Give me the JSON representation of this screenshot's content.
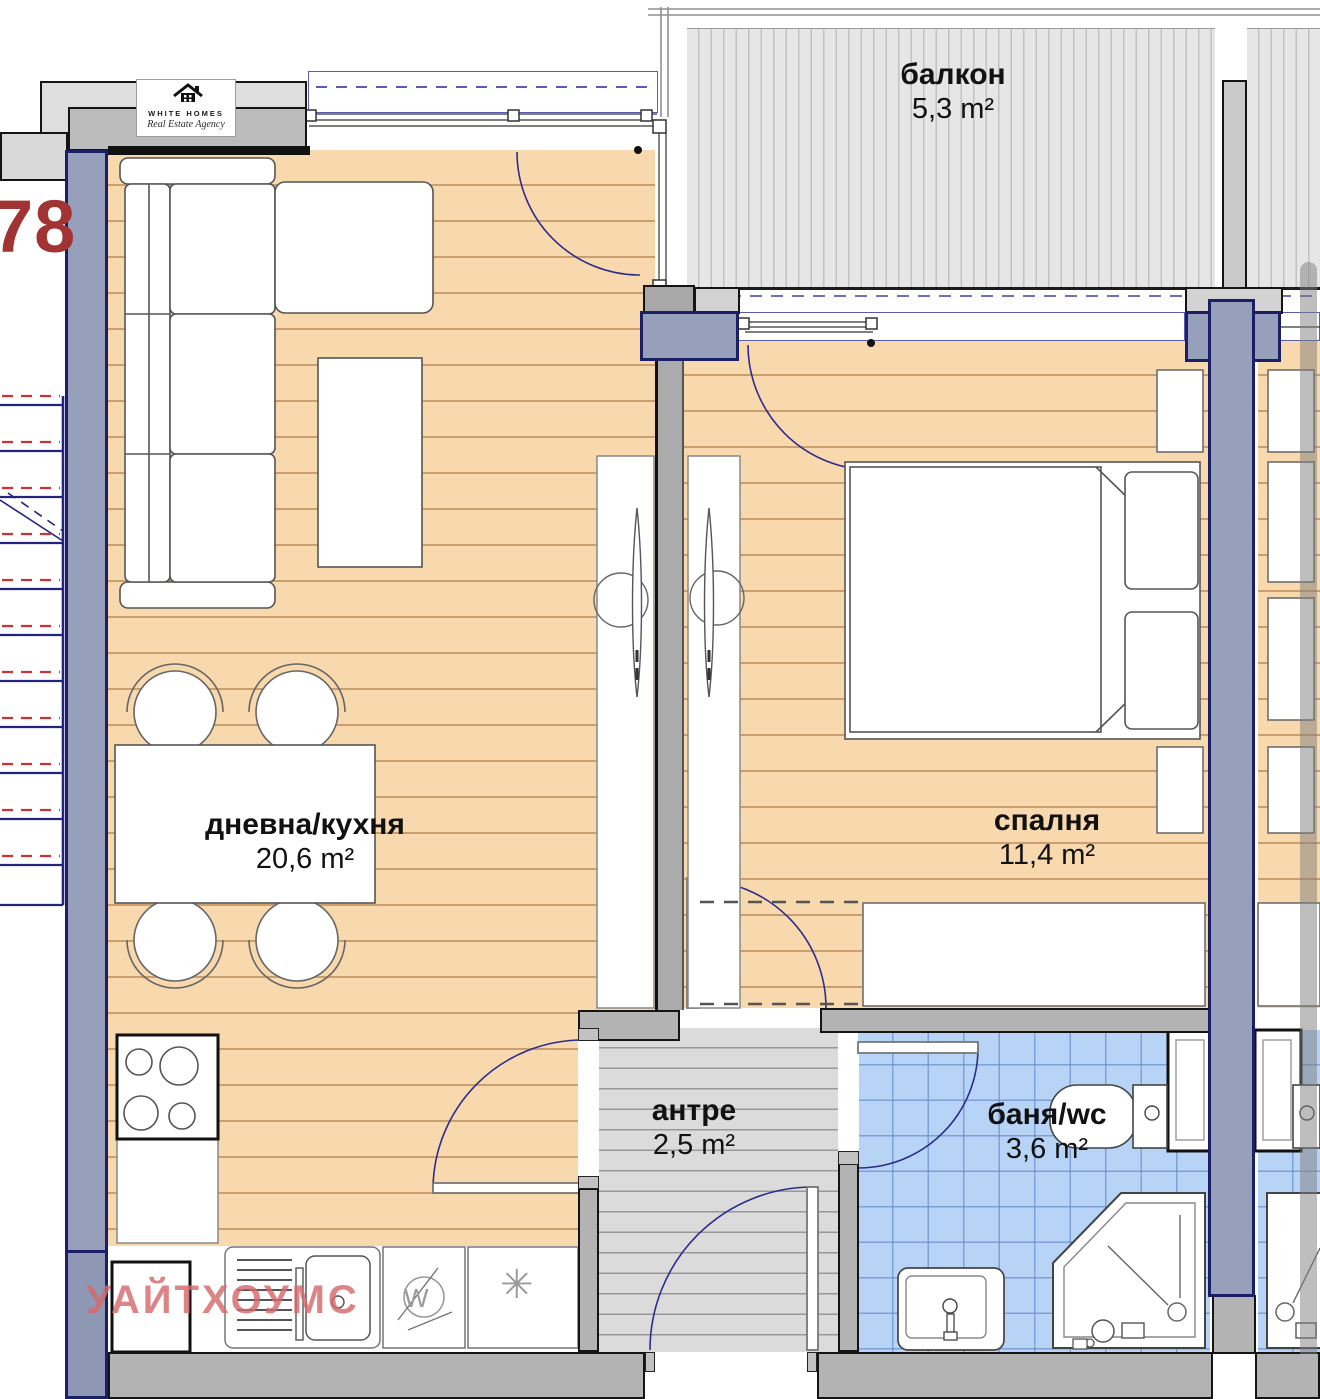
{
  "unit_label": "78",
  "logo": {
    "name": "WHITE HOMES",
    "tagline": "Real Estate Agency"
  },
  "watermark": "УАЙТХОУМС",
  "rooms": {
    "living": {
      "name": "дневна/кухня",
      "area": "20,6 m²"
    },
    "bedroom": {
      "name": "спалня",
      "area": "11,4 m²"
    },
    "hall": {
      "name": "антре",
      "area": "2,5 m²"
    },
    "bath": {
      "name": "баня/wc",
      "area": "3,6 m²"
    },
    "balcony": {
      "name": "балкон",
      "area": "5,3 m²"
    }
  },
  "appliances": {
    "washer_label": "W",
    "dishwasher_symbol": "✳"
  },
  "palette": {
    "floor_wood": "#f8d8ad",
    "floor_tile": "#b7d3f5",
    "floor_hall": "#dbdbdb",
    "balcony_deck": "#e6e6e6",
    "wall_gray": "#b3b3b3",
    "structure_fill": "#97a0bb",
    "structure_border": "#1b2066",
    "door_arc": "#2b2b8f",
    "stair_red": "#cc3333",
    "unit_number_red": "#a23333",
    "watermark_pink": "#d6696c"
  }
}
